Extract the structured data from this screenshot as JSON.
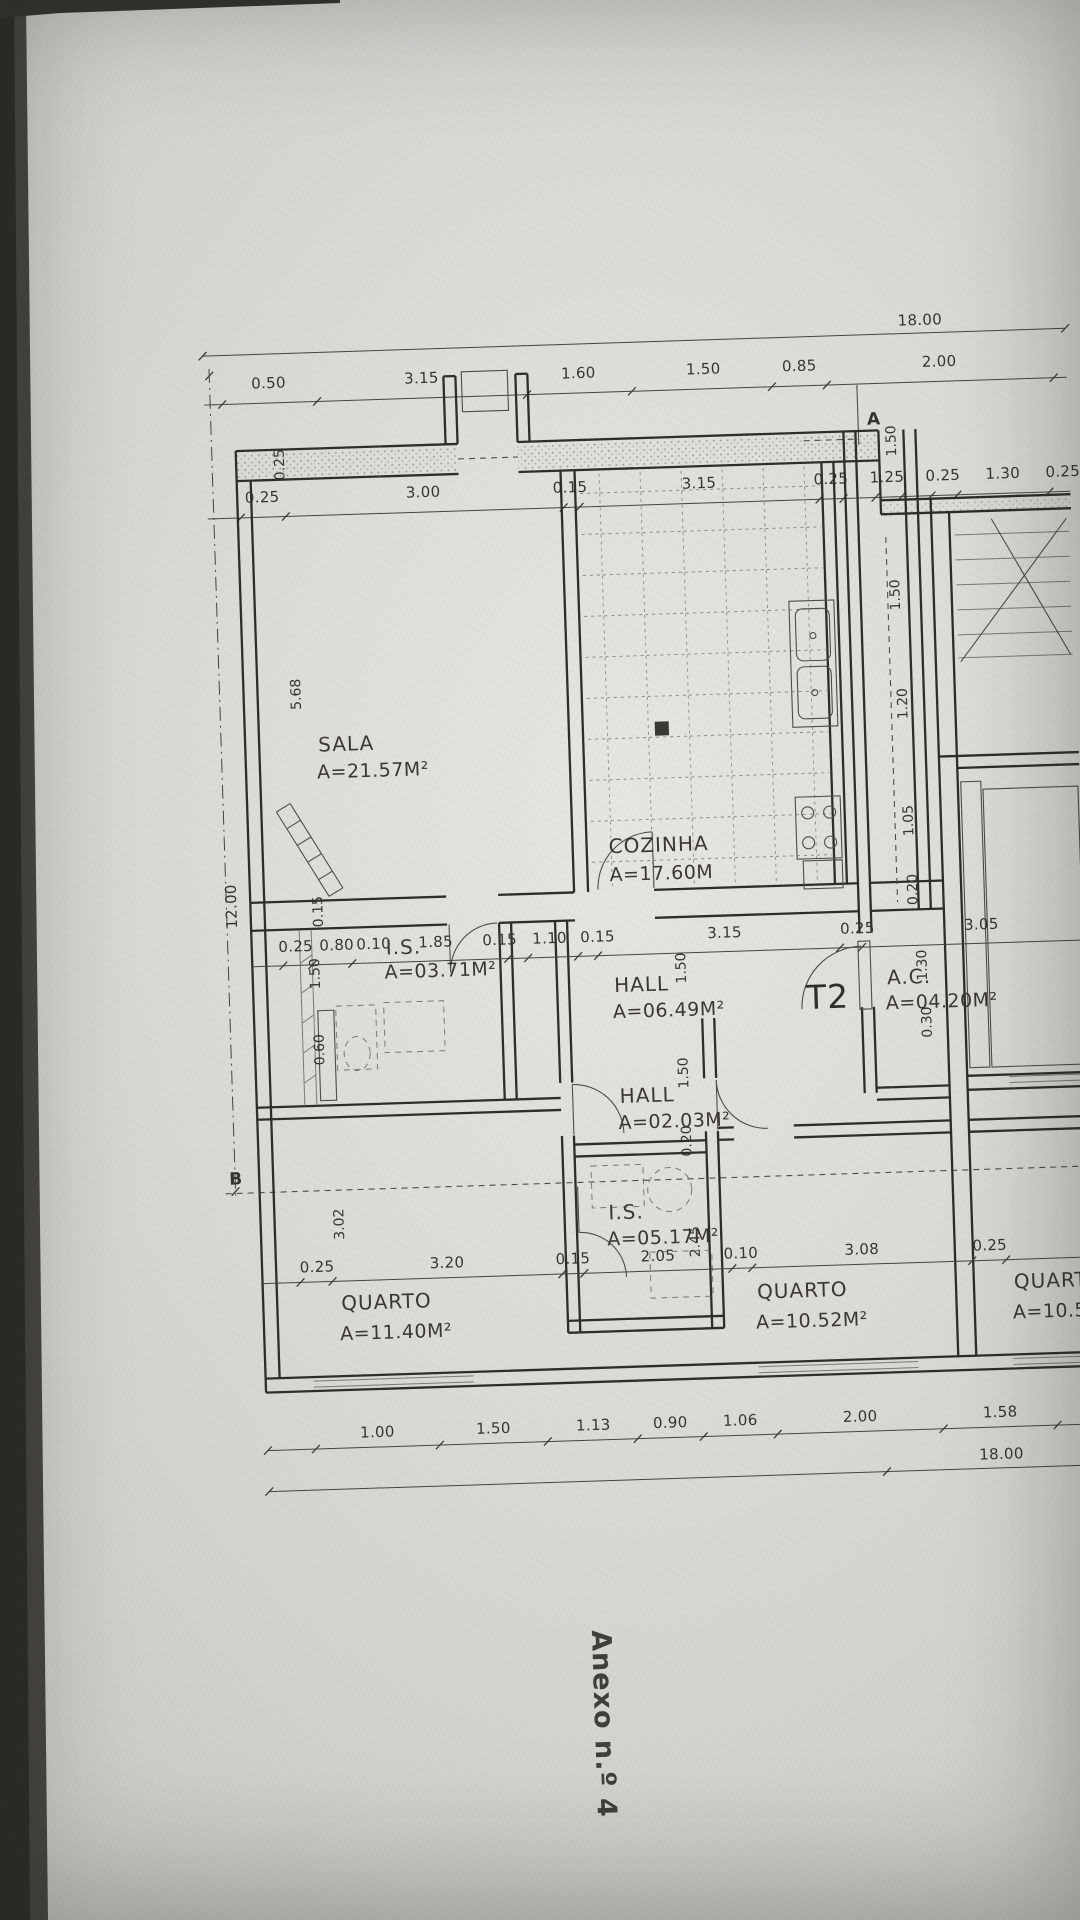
{
  "title": {
    "annex": "Anexo n.º 4"
  },
  "markers": {
    "a": "A",
    "b": "B"
  },
  "rooms": {
    "sala": {
      "name": "SALA",
      "area": "A=21.57M²"
    },
    "cozinha": {
      "name": "COZINHA",
      "area": "A=17.60M"
    },
    "is1": {
      "name": "I.S.",
      "area": "A=03.71M²"
    },
    "hall1": {
      "name": "HALL",
      "area": "A=06.49M²"
    },
    "t2": {
      "name": "T2"
    },
    "ac": {
      "name": "A.C.",
      "area": "A=04.20M²"
    },
    "hall2": {
      "name": "HALL",
      "area": "A=02.03M²"
    },
    "is2": {
      "name": "I.S.",
      "area": "A=05.17M²"
    },
    "quarto1": {
      "name": "QUARTO",
      "area": "A=11.40M²"
    },
    "quarto2": {
      "name": "QUARTO",
      "area": "A=10.52M²"
    },
    "quarto3": {
      "name": "QUARTO",
      "area": "A=10.52M²"
    }
  },
  "dims": {
    "top_total": "18.00",
    "row2": [
      "0.50",
      "3.15",
      "1.60",
      "1.50",
      "0.85",
      "2.00"
    ],
    "row3": [
      "0.25",
      "3.00",
      "0.15",
      "3.15",
      "0.25",
      "1.25",
      "0.25",
      "1.30",
      "0.25"
    ],
    "mid": [
      "0.25",
      "0.80",
      "0.10",
      "1.85",
      "0.15",
      "1.10",
      "0.15",
      "3.15",
      "0.25",
      "3.05"
    ],
    "quarto": [
      "0.25",
      "3.20",
      "0.15",
      "2.05",
      "0.10",
      "3.08",
      "0.25"
    ],
    "bottom": [
      "1.00",
      "1.50",
      "1.13",
      "0.90",
      "1.06",
      "2.00",
      "1.58"
    ],
    "bottom_total": "18.00",
    "left_total": "12.00",
    "vleft": [
      "0.25",
      "5.68",
      "0.15",
      "1.50",
      "0.60",
      "3.02"
    ],
    "vinner": [
      "1.50",
      "1.50",
      "0.20",
      "2.45"
    ],
    "vright": [
      "1.50",
      "1.20",
      "1.05",
      "0.20",
      "1.30",
      "0.30"
    ],
    "ventry": "1.50"
  }
}
